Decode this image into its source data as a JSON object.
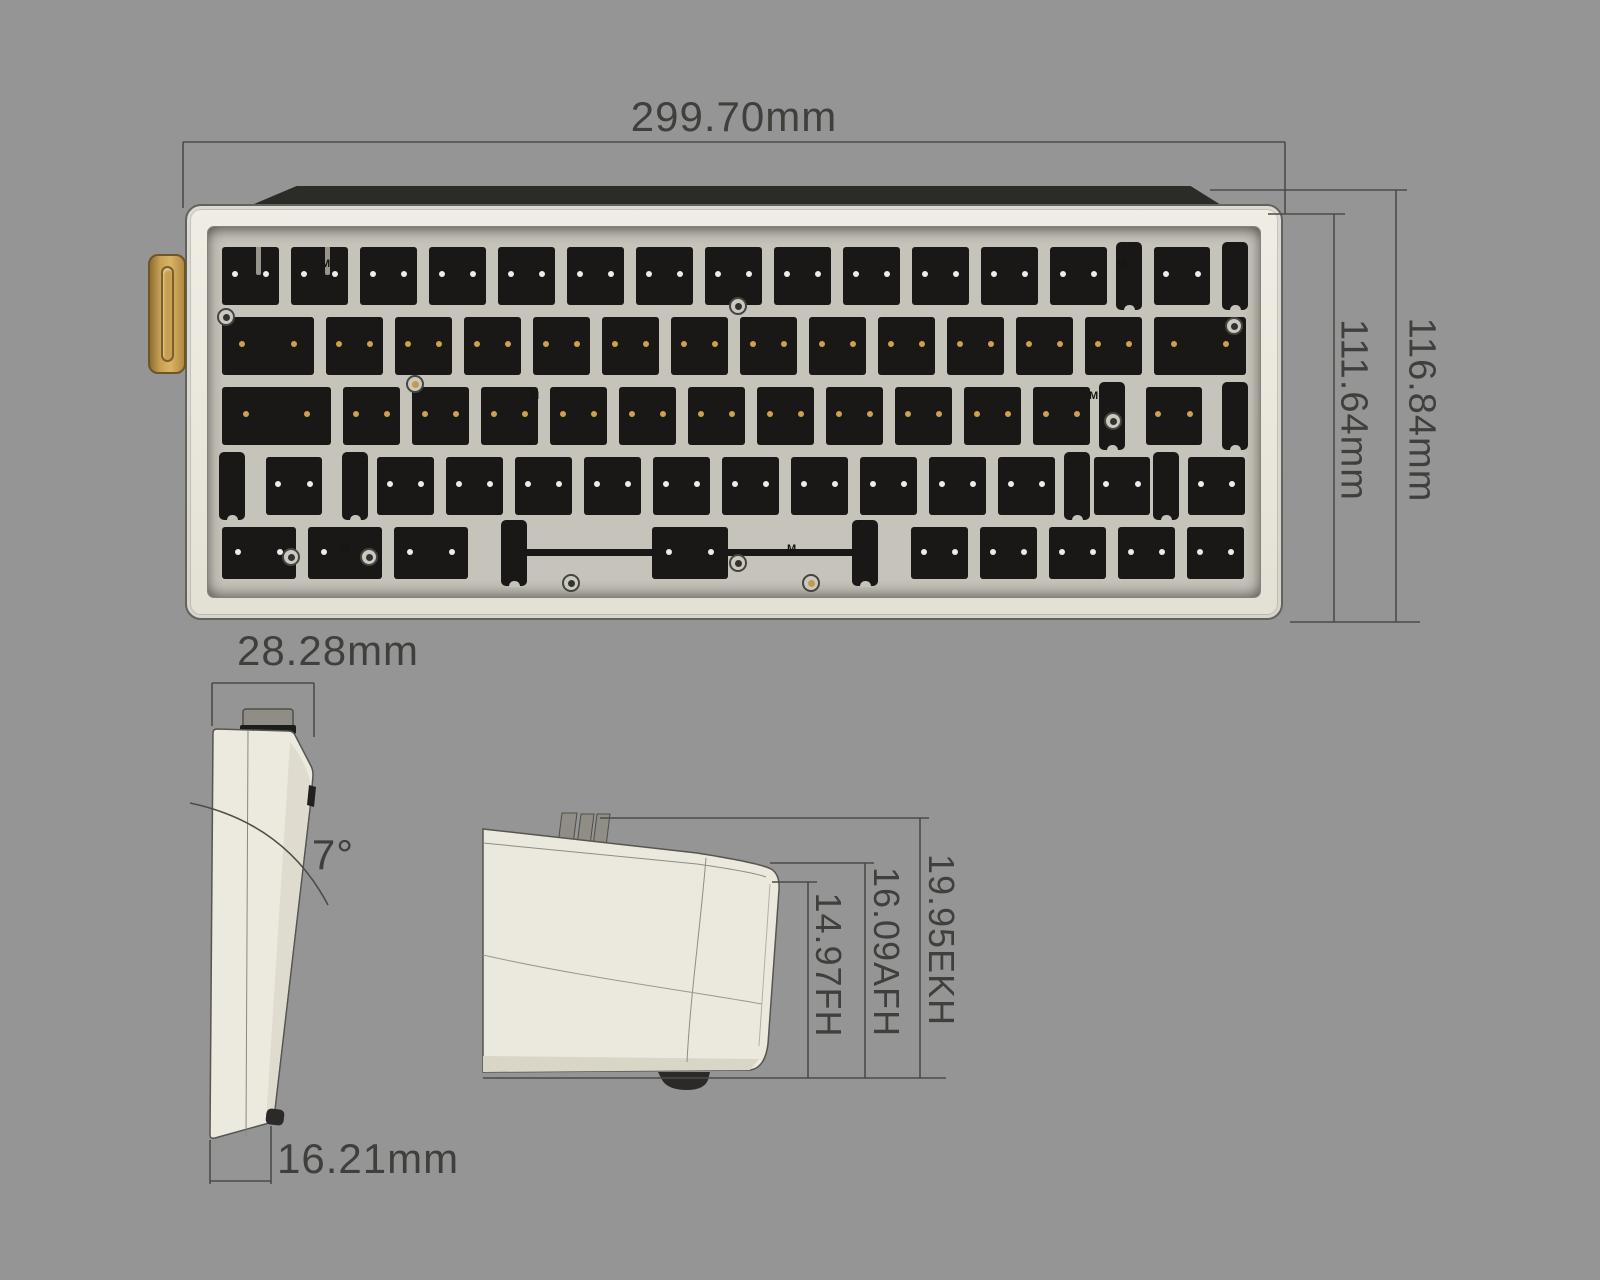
{
  "background": "#959595",
  "dimensions": {
    "top_width": "299.70mm",
    "case_inner_height": "111.64mm",
    "case_outer_height": "116.84mm",
    "side_depth": "28.28mm",
    "typing_angle": "7°",
    "side_height": "16.21mm",
    "front_height": "14.97FH",
    "alt_front_height": "16.09AFH",
    "keycap_height": "19.95EKH"
  },
  "colors": {
    "case": "#eae7dd",
    "plate": "#c6c3ba",
    "cutout": "#191816",
    "accent_gold": "#c9a053",
    "back_strip": "#2b2b28",
    "dim_line": "#4c4b47",
    "dim_text": "#403f3b"
  },
  "plate": {
    "unit_px": 69,
    "start_x": 8,
    "rows": [
      {
        "y": 20,
        "h": 58,
        "dot": "#ececec",
        "keys": [
          1,
          1,
          1,
          1,
          1,
          1,
          1,
          1,
          1,
          1,
          1,
          1,
          1,
          {
            "w": 2,
            "stab": true
          }
        ]
      },
      {
        "y": 90,
        "h": 58,
        "dot": "#cfa14e",
        "keys": [
          1.5,
          1,
          1,
          1,
          1,
          1,
          1,
          1,
          1,
          1,
          1,
          1,
          1,
          1.5
        ]
      },
      {
        "y": 160,
        "h": 58,
        "dot": "#cfa14e",
        "keys": [
          1.75,
          1,
          1,
          1,
          1,
          1,
          1,
          1,
          1,
          1,
          1,
          1,
          {
            "w": 2.25,
            "stab": true
          }
        ]
      },
      {
        "y": 230,
        "h": 58,
        "dot": "#ececec",
        "keys": [
          {
            "w": 2.25,
            "stab": true
          },
          1,
          1,
          1,
          1,
          1,
          1,
          1,
          1,
          1,
          1,
          {
            "w": 1.75,
            "stab": true
          },
          1
        ]
      },
      {
        "y": 300,
        "h": 52,
        "dot": "#ececec",
        "keys": [
          1.25,
          1.25,
          1.25,
          {
            "w": 6.25,
            "space": true
          },
          1,
          1,
          1,
          1,
          1
        ]
      }
    ],
    "rings": [
      {
        "x": 18,
        "y": 90,
        "t": "dark"
      },
      {
        "x": 530,
        "y": 79,
        "t": "dark"
      },
      {
        "x": 1026,
        "y": 99,
        "t": "dark"
      },
      {
        "x": 207,
        "y": 157,
        "t": "gold"
      },
      {
        "x": 905,
        "y": 194,
        "t": "dark"
      },
      {
        "x": 83,
        "y": 330,
        "t": "dark"
      },
      {
        "x": 161,
        "y": 330,
        "t": "dark"
      },
      {
        "x": 363,
        "y": 356,
        "t": "dark"
      },
      {
        "x": 530,
        "y": 336,
        "t": "dark"
      },
      {
        "x": 603,
        "y": 356,
        "t": "gold"
      }
    ],
    "marks": [
      {
        "x": 113,
        "y": 32,
        "glyph": "M"
      },
      {
        "x": 909,
        "y": 32,
        "glyph": "M"
      },
      {
        "x": 322,
        "y": 164,
        "glyph": "M"
      },
      {
        "x": 881,
        "y": 164,
        "glyph": "M"
      },
      {
        "x": 132,
        "y": 317,
        "glyph": "M"
      },
      {
        "x": 579,
        "y": 317,
        "glyph": "M"
      }
    ]
  }
}
